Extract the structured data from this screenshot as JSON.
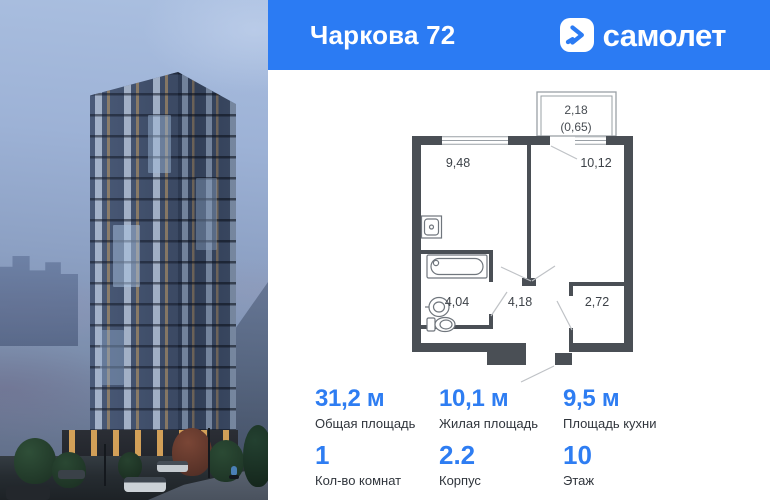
{
  "header": {
    "title": "Чаркова 72",
    "brand": "самолет"
  },
  "plan": {
    "balcony": {
      "width": "2,18",
      "area": "(0,65)"
    },
    "rooms": {
      "kitchen": "9,48",
      "living": "10,12",
      "bathroom": "4,04",
      "hallway": "4,18",
      "closet": "2,72"
    }
  },
  "stats": [
    {
      "value": "31,2 м",
      "label": "Общая площадь"
    },
    {
      "value": "10,1 м",
      "label": "Жилая площадь"
    },
    {
      "value": "9,5 м",
      "label": "Площадь кухни"
    }
  ],
  "meta": [
    {
      "value": "1",
      "label": "Кол-во комнат"
    },
    {
      "value": "2.2",
      "label": "Корпус"
    },
    {
      "value": "10",
      "label": "Этаж"
    }
  ],
  "colors": {
    "brand_blue": "#2b7bf3",
    "wall": "#4a4f55"
  }
}
